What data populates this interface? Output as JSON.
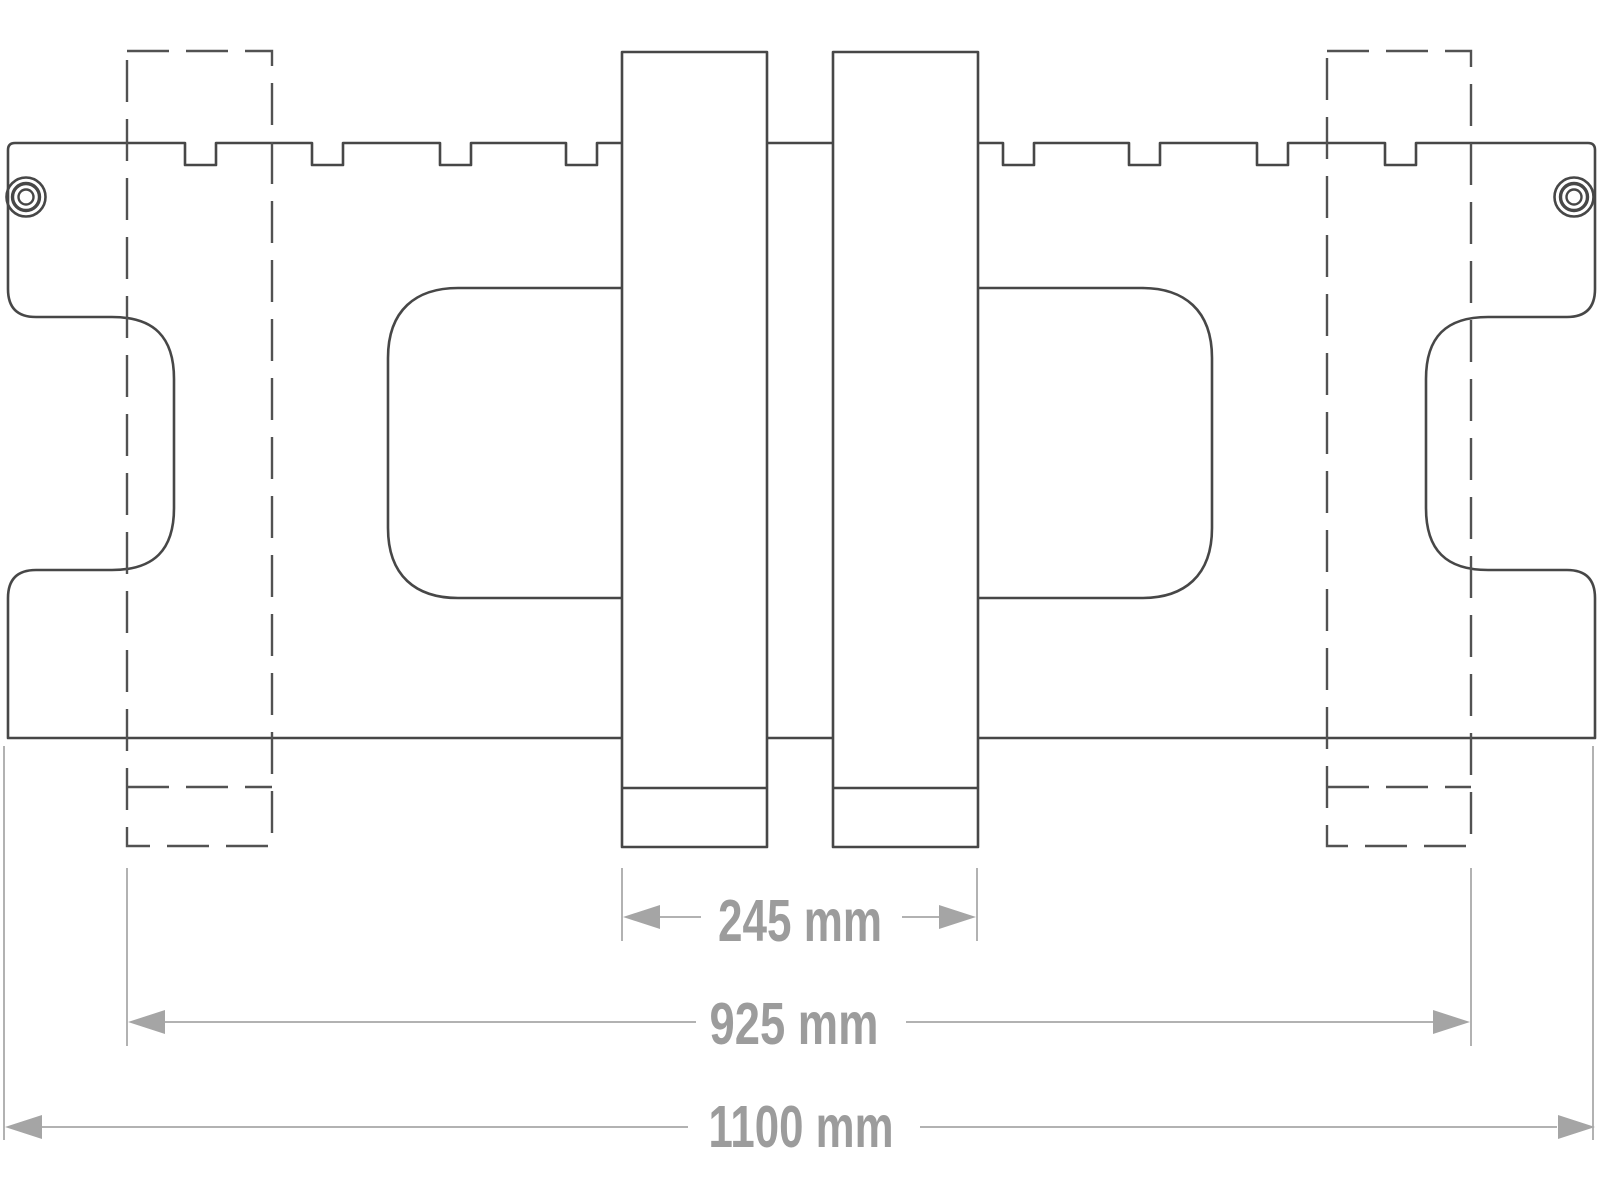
{
  "title": "Fork carriage front-view technical drawing",
  "drawing": {
    "units": "mm",
    "dimensions": [
      {
        "id": "fork-outer-spacing",
        "label": "245 mm",
        "value": 245
      },
      {
        "id": "outer-fork-position-span",
        "label": "925 mm",
        "value": 925
      },
      {
        "id": "overall-width",
        "label": "1100 mm",
        "value": 1100
      }
    ],
    "features": {
      "solid_forks": 2,
      "dashed_alternate_fork_positions": 2,
      "mounting_bolts": 2,
      "top_edge_notches": 8,
      "window_cutouts": 2
    },
    "colors": {
      "outline": "#474747",
      "dashed": "#525252",
      "dimension_line": "#b2b2b2",
      "dimension_arrow": "#a5a5a5",
      "dimension_text": "#9c9c9c",
      "background": "#ffffff"
    }
  }
}
